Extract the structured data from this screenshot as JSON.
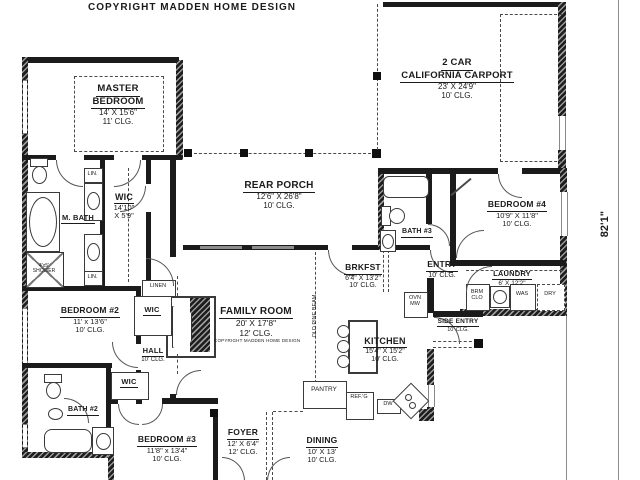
{
  "header": {
    "copyright": "COPYRIGHT MADDEN HOME DESIGN"
  },
  "dimension": {
    "overall_height": "82'1\""
  },
  "rooms": {
    "master": {
      "name1": "MASTER",
      "name2": "BEDROOM",
      "dims": "14' X 15'6\"",
      "clg": "11' CLG."
    },
    "carport": {
      "name1": "2 CAR",
      "name2": "CALIFORNIA CARPORT",
      "dims": "23' X 24'9\"",
      "clg": "10' CLG."
    },
    "rear_porch": {
      "name": "REAR PORCH",
      "dims": "12'6\" X 26'8\"",
      "clg": "10' CLG."
    },
    "bedroom4": {
      "name": "BEDROOM #4",
      "dims": "10'9\" X 11'8\"",
      "clg": "10' CLG."
    },
    "bath3": {
      "name": "BATH #3"
    },
    "entry": {
      "name": "ENTRY",
      "clg": "10' CLG."
    },
    "laundry": {
      "name": "LAUNDRY",
      "dims": "6' X 12'2\""
    },
    "side_entry": {
      "name": "SIDE ENTRY",
      "clg": "10' CLG."
    },
    "wic_master": {
      "name": "WIC",
      "dims1": "14'10\"",
      "dims2": "X 5'9\""
    },
    "mbath": {
      "name": "M. BATH"
    },
    "shower": {
      "line1": "4'x5'",
      "line2": "SHOWER"
    },
    "family": {
      "name": "FAMILY ROOM",
      "dims": "20' X 17'8\"",
      "clg": "12' CLG.",
      "copyright": "COPYRIGHT MADDEN HOME DESIGN"
    },
    "brkfst": {
      "name": "BRKFST",
      "dims": "6'4\" X 13'2\"",
      "clg": "10' CLG."
    },
    "kitchen": {
      "name": "KITCHEN",
      "dims": "15'4\" X 15'2\"",
      "clg": "10' CLG."
    },
    "bedroom2": {
      "name": "BEDROOM #2",
      "dims": "11' x 13'6\"",
      "clg": "10' CLG."
    },
    "hall": {
      "name": "HALL",
      "clg": "10' CLG."
    },
    "bath2": {
      "name": "BATH #2"
    },
    "bedroom3": {
      "name": "BEDROOM #3",
      "dims": "11'8\" x 13'4\"",
      "clg": "10' CLG."
    },
    "foyer": {
      "name": "FOYER",
      "dims": "12' X 6'4\"",
      "clg": "12' CLG."
    },
    "dining": {
      "name": "DINING",
      "dims": "10' X 13'",
      "clg": "10' CLG."
    }
  },
  "labels": {
    "lin": "LIN.",
    "linen": "LINEN",
    "wic": "WIC",
    "pantry": "PANTRY",
    "refg": "REF.'G",
    "dw": "DW",
    "ovn": "OVN",
    "mw": "MW",
    "brm": "BRM",
    "clo": "CLO",
    "was": "WAS",
    "dry": "DRY",
    "old_pine_beam": "OLD PINE BEAM"
  }
}
